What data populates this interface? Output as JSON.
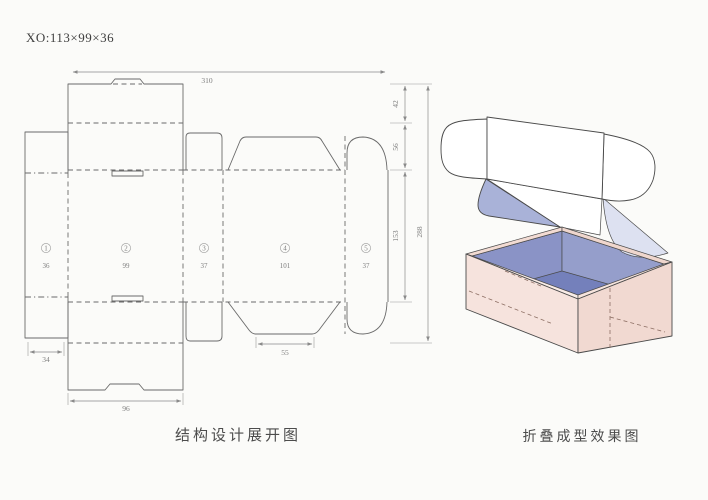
{
  "title": "XO:113×99×36",
  "dieline": {
    "caption": "结构设计展开图",
    "panels": [
      {
        "num": "1",
        "width": "36"
      },
      {
        "num": "2",
        "width": "99"
      },
      {
        "num": "3",
        "width": "37"
      },
      {
        "num": "4",
        "width": "101"
      },
      {
        "num": "5",
        "width": "37"
      }
    ],
    "dims": {
      "total_width": "310",
      "lid_depth": "42",
      "flap_depth": "56",
      "body_depth": "153",
      "total_depth": "288",
      "side_flap": "34",
      "tuck_flap": "55",
      "bottom_lid": "96"
    }
  },
  "render": {
    "caption": "折叠成型效果图"
  },
  "colors": {
    "box_outer_left": "#f6e3dd",
    "box_outer_right": "#f1d9d1",
    "rim_front_left": "#f9ece7",
    "rim_front_right": "#f6e4dd",
    "rim_back": "#f2dbd3",
    "inner_wall_left": "#8a93c6",
    "inner_wall_right": "#959ecb",
    "interior_floor": "#7480bb",
    "flap_light": "#dde1f1",
    "flap_medium": "#a9b2d8",
    "line": "#6a6a6a"
  }
}
